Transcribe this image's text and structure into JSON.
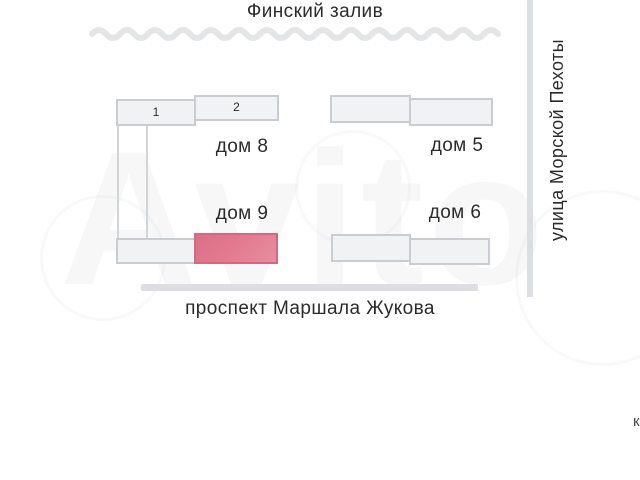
{
  "map": {
    "title_water": "Финский залив",
    "street_right": "улица Морской Пехоты",
    "street_bottom": "проспект Маршала Жукова",
    "watermark": "Avito",
    "corner_char": "к",
    "buildings": [
      {
        "label": "дом 8",
        "sections": [
          "1",
          "2"
        ],
        "highlighted": false
      },
      {
        "label": "дом 9",
        "highlighted": true
      },
      {
        "label": "дом 5",
        "highlighted": false
      },
      {
        "label": "дом 6",
        "highlighted": false
      }
    ],
    "colors": {
      "highlight_fill": "#e2798e",
      "highlight_border": "#d06a7f",
      "building_fill": "#f1f2f3",
      "building_border": "#c9ccd0",
      "road": "#dcdee1",
      "wave": "#e3e5e7",
      "text": "#2b2b2b"
    }
  }
}
